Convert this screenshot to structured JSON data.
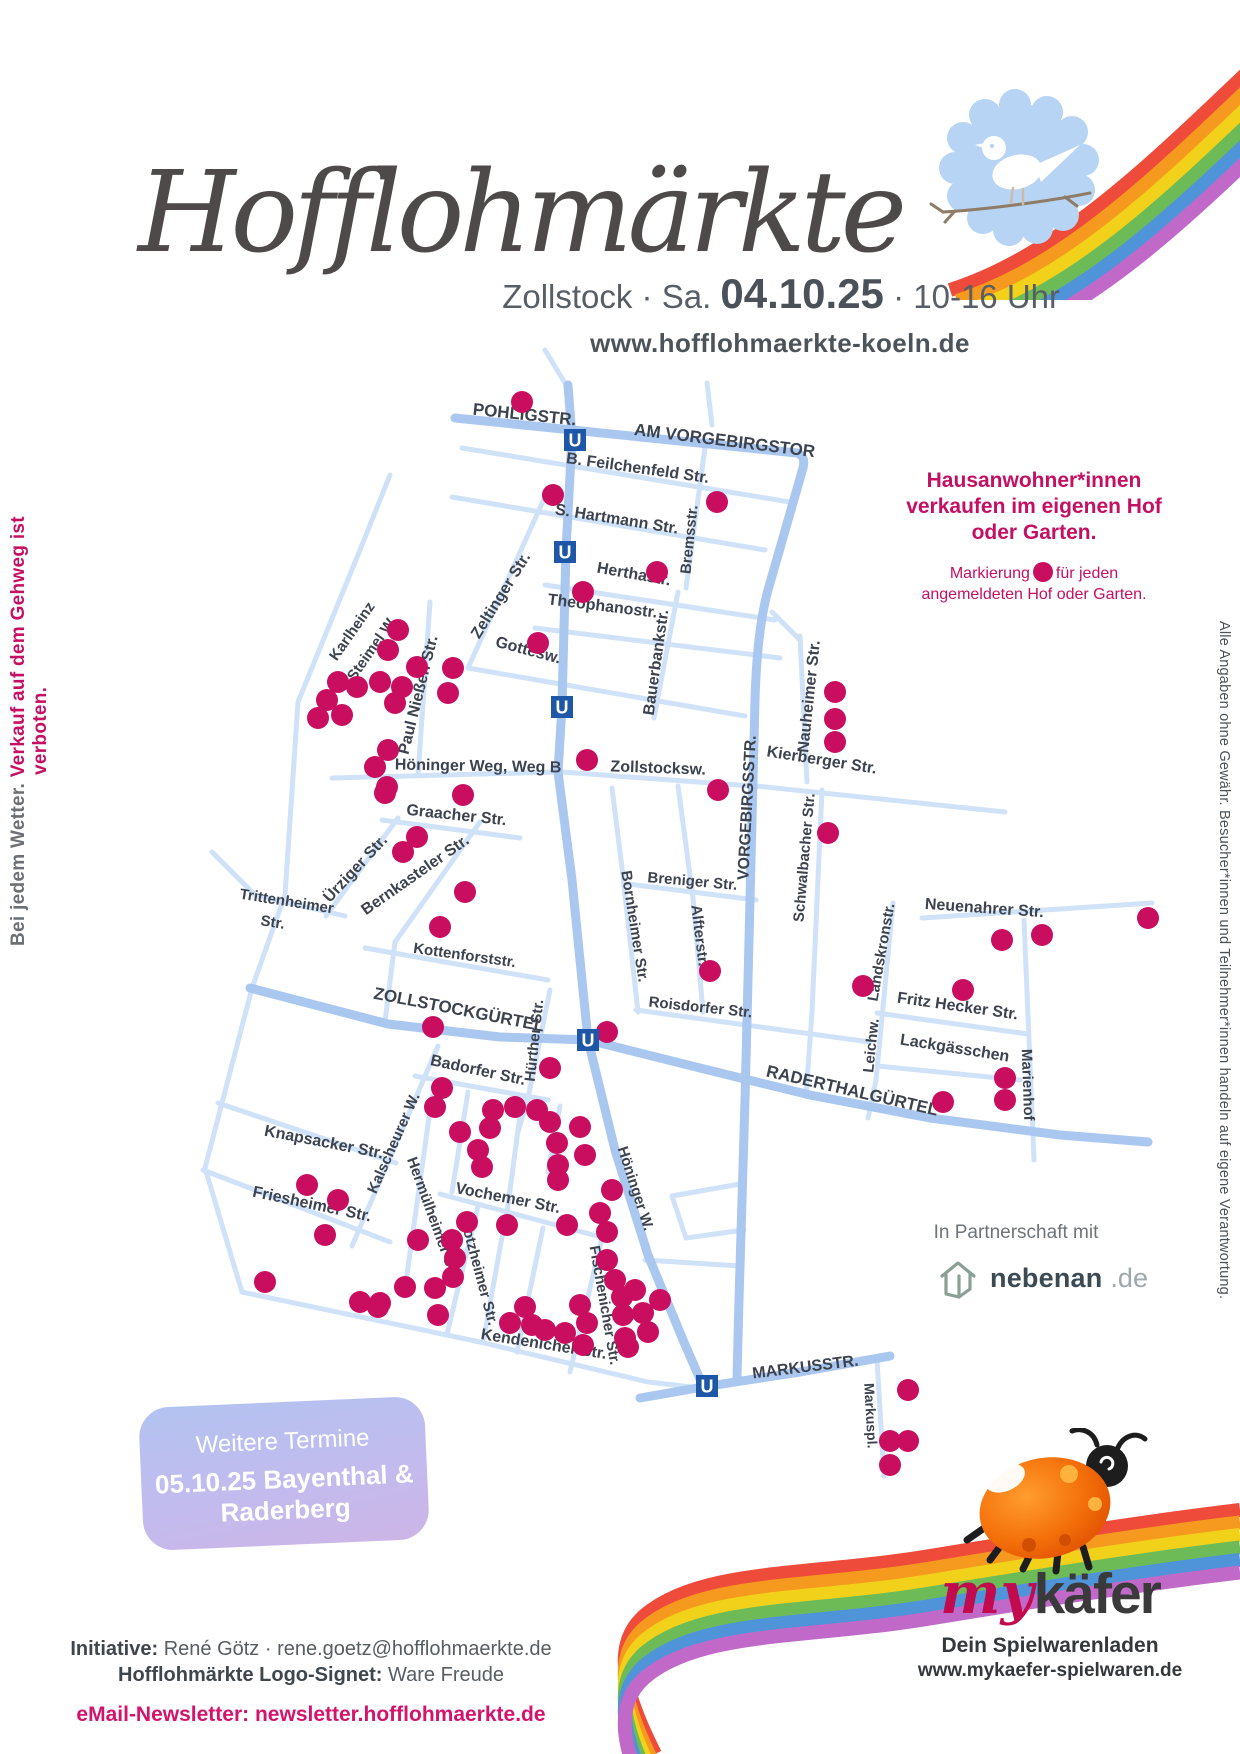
{
  "header": {
    "title": "Hofflohmärkte",
    "subtitle_location": "Zollstock",
    "subtitle_sep1": " · Sa. ",
    "subtitle_date": "04.10.25",
    "subtitle_sep2": " · ",
    "subtitle_time": "10-16 Uhr",
    "website": "www.hofflohmaerkte-koeln.de"
  },
  "side_notes": {
    "left_gray": "Bei jedem Wetter. ",
    "left_pink": "Verkauf auf dem Gehweg ist verboten.",
    "right": "Alle Angaben ohne Gewähr. Besucher*innen und Teilnehmer*innen handeln auf eigene Verantwortung."
  },
  "info_box": {
    "line1": "Hausanwohner*innen",
    "line2": "verkaufen im eigenen Hof",
    "line3": "oder Garten.",
    "marker_pre": "Markierung",
    "marker_post": "für jeden",
    "marker_line2": "angemeldeten Hof oder Garten."
  },
  "partner": {
    "label": "In Partnerschaft mit",
    "brand": "nebenan",
    "tld": ".de"
  },
  "dates_box": {
    "heading": "Weitere Termine",
    "line1": "05.10.25 Bayenthal &",
    "line2": "Raderberg"
  },
  "footer": {
    "initiative_label": "Initiative:",
    "initiative_value": " René Götz · rene.goetz@hofflohmaerkte.de",
    "signet_label": "Hofflohmärkte Logo-Signet:",
    "signet_value": " Ware Freude",
    "newsletter": "eMail-Newsletter: newsletter.hofflohmaerkte.de"
  },
  "sponsor": {
    "brand_prefix": "my",
    "brand_suffix": "käfer",
    "tagline": "Dein Spielwarenladen",
    "website": "www.mykaefer-spielwaren.de"
  },
  "theme": {
    "accent_pink": "#c50f63",
    "rainbow": [
      "#ee4b3b",
      "#f6991f",
      "#f2d11b",
      "#6dbb57",
      "#4f94d8",
      "#c069c9"
    ]
  },
  "map": {
    "street_color": "#cfe2f8",
    "main_street_color": "#aac7f0",
    "label_color": "#3c434e",
    "dot_color": "#c90e60",
    "u_color": "#1e57a8",
    "u_label": "U",
    "dot_radius": 11,
    "streets_main": [
      "M455,418 L797,453 Q806,456 803,468 L768,590 Q757,630 755,700 L750,900 L745,1100 L739,1300 L737,1378",
      "M568,385 L572,438 L566,550 L562,706 L558,772 L572,880 L588,1040 L615,1150 L648,1255 L683,1340 L703,1386",
      "M250,988 L388,1024 L500,1037 L588,1040 L700,1068 L810,1095 L930,1118 L1060,1135 L1148,1142",
      "M640,1398 L703,1387 L800,1372 L890,1356"
    ],
    "streets": [
      "M545,350 L568,388",
      "M707,383 L712,425",
      "M462,448 L790,502",
      "M452,497 L765,550",
      "M545,585 L775,620",
      "M535,628 L780,658",
      "M706,440 L686,588",
      "M678,592 L654,718",
      "M548,490 L468,668",
      "M468,668 L745,716",
      "M362,545 L298,702",
      "M298,702 L285,895 L252,988",
      "M390,475 L362,545",
      "M430,602 L418,775",
      "M332,778 L558,772",
      "M562,772 L752,786",
      "M756,786 L1005,812",
      "M800,636 L807,782",
      "M800,640 L772,612",
      "M822,790 L812,1012",
      "M382,820 L520,838",
      "M398,818 L326,916",
      "M480,822 L395,942",
      "M212,852 L255,895 L345,916",
      "M365,948 L548,980",
      "M395,942 L385,1022",
      "M612,788 L622,868 L638,1012",
      "M628,884 L756,900",
      "M693,898 L703,1012",
      "M678,786 L693,898",
      "M636,1010 L870,1042",
      "M812,1012 L806,1096",
      "M922,918 L1152,903",
      "M893,903 L876,1080",
      "M876,1080 L868,1118",
      "M877,1013 L1028,1034",
      "M877,1066 L1020,1080",
      "M1024,920 L1034,1160",
      "M550,990 L528,1098 L518,1132",
      "M415,1076 L548,1100",
      "M438,1046 L352,1246",
      "M218,1103 L396,1163",
      "M203,1170 L390,1242",
      "M252,988 L205,1168",
      "M205,1168 L242,1292",
      "M242,1292 L480,1342 L648,1382 L700,1388",
      "M432,1096 L404,1296",
      "M440,1194 L612,1240",
      "M478,1206 L447,1334",
      "M602,1238 L570,1372",
      "M505,1220 L484,1338",
      "M543,1228 L517,1352",
      "M468,1092 L452,1192",
      "M522,1100 L506,1220",
      "M560,1106 L548,1172",
      "M672,1196 L740,1184",
      "M672,1196 L686,1238",
      "M686,1238 L744,1230",
      "M645,1260 L740,1266",
      "M877,1360 L884,1476"
    ],
    "u_stations": [
      [
        575,
        440
      ],
      [
        565,
        552
      ],
      [
        562,
        707
      ],
      [
        588,
        1040
      ],
      [
        707,
        1386
      ]
    ],
    "labels": [
      {
        "t": "POHLIGSTR.",
        "x": 524,
        "y": 420,
        "r": 6,
        "s": 17
      },
      {
        "t": "AM VORGEBIRGSTOR",
        "x": 724,
        "y": 446,
        "r": 7,
        "s": 17
      },
      {
        "t": "B. Feilchenfeld Str.",
        "x": 637,
        "y": 473,
        "r": 8,
        "s": 16
      },
      {
        "t": "S. Hartmann Str.",
        "x": 616,
        "y": 524,
        "r": 9,
        "s": 16
      },
      {
        "t": "Herthastr.",
        "x": 633,
        "y": 579,
        "r": 10,
        "s": 16
      },
      {
        "t": "Theophanostr.",
        "x": 602,
        "y": 611,
        "r": 7,
        "s": 16
      },
      {
        "t": "Bremsstr.",
        "x": 694,
        "y": 540,
        "r": -84,
        "s": 15
      },
      {
        "t": "Zeltinger Str.",
        "x": 505,
        "y": 598,
        "r": -58,
        "s": 16
      },
      {
        "t": "Gottesw.",
        "x": 527,
        "y": 655,
        "r": 15,
        "s": 16
      },
      {
        "t": "Bauerbankstr.",
        "x": 661,
        "y": 663,
        "r": -82,
        "s": 16
      },
      {
        "t": "Karlheinz",
        "x": 356,
        "y": 634,
        "r": -55,
        "s": 15
      },
      {
        "t": "Steimel W.",
        "x": 376,
        "y": 651,
        "r": -55,
        "s": 15
      },
      {
        "t": "Paul Nießen Str.",
        "x": 423,
        "y": 696,
        "r": -76,
        "s": 16
      },
      {
        "t": "Nauheimer Str.",
        "x": 814,
        "y": 697,
        "r": -84,
        "s": 16
      },
      {
        "t": "Höninger Weg, Weg B",
        "x": 478,
        "y": 771,
        "r": 1,
        "s": 16
      },
      {
        "t": "Zollstocksw.",
        "x": 658,
        "y": 773,
        "r": 2,
        "s": 16
      },
      {
        "t": "Kierberger Str.",
        "x": 821,
        "y": 765,
        "r": 9,
        "s": 16
      },
      {
        "t": "VORGEBIRGSSTR.",
        "x": 752,
        "y": 808,
        "r": -87,
        "s": 16
      },
      {
        "t": "Schwalbacher Str.",
        "x": 809,
        "y": 858,
        "r": -85,
        "s": 15
      },
      {
        "t": "Graacher Str.",
        "x": 456,
        "y": 820,
        "r": 6,
        "s": 16
      },
      {
        "t": "Ürziger Str.",
        "x": 359,
        "y": 872,
        "r": -47,
        "s": 16
      },
      {
        "t": "Bernkasteler Str.",
        "x": 418,
        "y": 879,
        "r": -35,
        "s": 16
      },
      {
        "t": "Trittenheimer",
        "x": 286,
        "y": 906,
        "r": 9,
        "s": 15
      },
      {
        "t": "Str.",
        "x": 272,
        "y": 927,
        "r": 9,
        "s": 15
      },
      {
        "t": "Kottenforststr.",
        "x": 464,
        "y": 960,
        "r": 8,
        "s": 15
      },
      {
        "t": "Bornheimer Str.",
        "x": 630,
        "y": 927,
        "r": 81,
        "s": 15
      },
      {
        "t": "Breniger Str.",
        "x": 692,
        "y": 886,
        "r": 5,
        "s": 15
      },
      {
        "t": "Alfterstr.",
        "x": 695,
        "y": 936,
        "r": 83,
        "s": 15
      },
      {
        "t": "Roisdorfer Str.",
        "x": 700,
        "y": 1012,
        "r": 6,
        "s": 15
      },
      {
        "t": "Neuenahrer Str.",
        "x": 984,
        "y": 913,
        "r": 4,
        "s": 16
      },
      {
        "t": "Landskronstr.",
        "x": 886,
        "y": 953,
        "r": -80,
        "s": 15
      },
      {
        "t": "Fritz Hecker Str.",
        "x": 957,
        "y": 1011,
        "r": 8,
        "s": 16
      },
      {
        "t": "Lackgässchen",
        "x": 954,
        "y": 1053,
        "r": 9,
        "s": 16
      },
      {
        "t": "Leichw.",
        "x": 876,
        "y": 1046,
        "r": -84,
        "s": 15
      },
      {
        "t": "Marienhof",
        "x": 1023,
        "y": 1085,
        "r": 88,
        "s": 15
      },
      {
        "t": "RADERTHALGÜRTEL",
        "x": 851,
        "y": 1096,
        "r": 13,
        "s": 17
      },
      {
        "t": "ZOLLSTOCKGÜRTEL",
        "x": 458,
        "y": 1015,
        "r": 11,
        "s": 17
      },
      {
        "t": "Hürther Str.",
        "x": 539,
        "y": 1041,
        "r": -84,
        "s": 15
      },
      {
        "t": "Badorfer Str.",
        "x": 477,
        "y": 1075,
        "r": 12,
        "s": 16
      },
      {
        "t": "Knapsacker Str.",
        "x": 323,
        "y": 1147,
        "r": 11,
        "s": 16
      },
      {
        "t": "Kalscheurer W.",
        "x": 398,
        "y": 1145,
        "r": -66,
        "s": 15
      },
      {
        "t": "Friesheimer Str.",
        "x": 311,
        "y": 1209,
        "r": 12,
        "s": 16
      },
      {
        "t": "Hermülheimer Str.",
        "x": 429,
        "y": 1220,
        "r": 70,
        "s": 15
      },
      {
        "t": "Vochemer Str.",
        "x": 507,
        "y": 1203,
        "r": 11,
        "s": 16
      },
      {
        "t": "Stotzheimer Str.",
        "x": 474,
        "y": 1271,
        "r": 75,
        "s": 15
      },
      {
        "t": "Höninger W.",
        "x": 631,
        "y": 1190,
        "r": 72,
        "s": 15
      },
      {
        "t": "Fischenicher Str.",
        "x": 600,
        "y": 1306,
        "r": 80,
        "s": 15
      },
      {
        "t": "Kendenicher Str.",
        "x": 543,
        "y": 1349,
        "r": 9,
        "s": 16
      },
      {
        "t": "MARKUSSTR.",
        "x": 806,
        "y": 1372,
        "r": -7,
        "s": 16
      },
      {
        "t": "Markuspl.",
        "x": 866,
        "y": 1416,
        "r": 87,
        "s": 14
      }
    ],
    "dots": [
      [
        522,
        402
      ],
      [
        553,
        495
      ],
      [
        717,
        502
      ],
      [
        583,
        592
      ],
      [
        657,
        572
      ],
      [
        538,
        643
      ],
      [
        398,
        630
      ],
      [
        388,
        650
      ],
      [
        338,
        682
      ],
      [
        357,
        687
      ],
      [
        380,
        682
      ],
      [
        402,
        687
      ],
      [
        327,
        700
      ],
      [
        395,
        703
      ],
      [
        318,
        718
      ],
      [
        342,
        715
      ],
      [
        417,
        667
      ],
      [
        453,
        668
      ],
      [
        448,
        693
      ],
      [
        388,
        750
      ],
      [
        375,
        767
      ],
      [
        387,
        787
      ],
      [
        587,
        760
      ],
      [
        718,
        790
      ],
      [
        835,
        692
      ],
      [
        835,
        719
      ],
      [
        835,
        742
      ],
      [
        828,
        833
      ],
      [
        385,
        793
      ],
      [
        463,
        795
      ],
      [
        417,
        837
      ],
      [
        403,
        852
      ],
      [
        465,
        892
      ],
      [
        440,
        927
      ],
      [
        710,
        971
      ],
      [
        863,
        986
      ],
      [
        1002,
        940
      ],
      [
        1042,
        935
      ],
      [
        1148,
        918
      ],
      [
        963,
        990
      ],
      [
        1005,
        1078
      ],
      [
        1005,
        1100
      ],
      [
        943,
        1102
      ],
      [
        433,
        1027
      ],
      [
        607,
        1032
      ],
      [
        550,
        1068
      ],
      [
        442,
        1088
      ],
      [
        435,
        1107
      ],
      [
        493,
        1110
      ],
      [
        515,
        1107
      ],
      [
        537,
        1110
      ],
      [
        550,
        1122
      ],
      [
        490,
        1128
      ],
      [
        460,
        1132
      ],
      [
        557,
        1143
      ],
      [
        580,
        1127
      ],
      [
        478,
        1150
      ],
      [
        558,
        1165
      ],
      [
        482,
        1167
      ],
      [
        585,
        1155
      ],
      [
        558,
        1180
      ],
      [
        600,
        1213
      ],
      [
        612,
        1190
      ],
      [
        607,
        1232
      ],
      [
        307,
        1185
      ],
      [
        338,
        1200
      ],
      [
        325,
        1235
      ],
      [
        418,
        1240
      ],
      [
        452,
        1240
      ],
      [
        455,
        1258
      ],
      [
        453,
        1277
      ],
      [
        435,
        1288
      ],
      [
        438,
        1315
      ],
      [
        405,
        1287
      ],
      [
        380,
        1303
      ],
      [
        467,
        1222
      ],
      [
        507,
        1225
      ],
      [
        567,
        1225
      ],
      [
        265,
        1282
      ],
      [
        360,
        1302
      ],
      [
        378,
        1307
      ],
      [
        525,
        1307
      ],
      [
        510,
        1323
      ],
      [
        532,
        1325
      ],
      [
        545,
        1330
      ],
      [
        565,
        1333
      ],
      [
        580,
        1305
      ],
      [
        587,
        1323
      ],
      [
        583,
        1345
      ],
      [
        607,
        1260
      ],
      [
        615,
        1280
      ],
      [
        622,
        1297
      ],
      [
        635,
        1290
      ],
      [
        623,
        1315
      ],
      [
        643,
        1313
      ],
      [
        648,
        1332
      ],
      [
        625,
        1338
      ],
      [
        628,
        1347
      ],
      [
        660,
        1300
      ],
      [
        908,
        1390
      ],
      [
        890,
        1441
      ],
      [
        908,
        1441
      ],
      [
        890,
        1465
      ]
    ]
  }
}
